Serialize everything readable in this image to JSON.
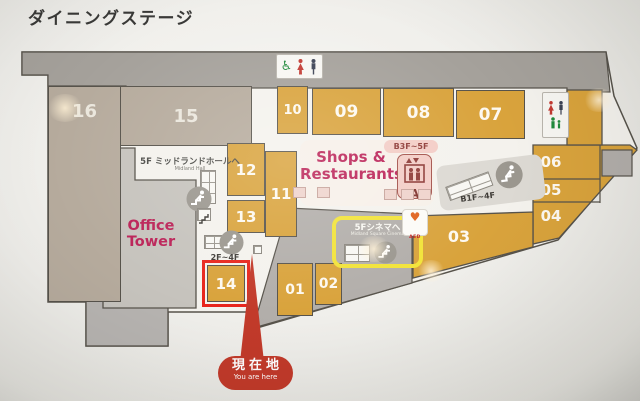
{
  "title": "ダイニングステージ",
  "sections": {
    "s16": "16",
    "s15": "15",
    "s10": "10",
    "s09": "09",
    "s08": "08",
    "s07": "07",
    "s12": "12",
    "s11": "11",
    "s13": "13",
    "s06": "06",
    "s05": "05",
    "s04": "04",
    "s03": "03",
    "s14": "14",
    "s01": "01",
    "s02": "02"
  },
  "areas": {
    "office_tower": "Office Tower",
    "shops_line1": "Shops &",
    "shops_line2": "Restaurants"
  },
  "destinations": {
    "midland_hall_jp": "5F ミッドランドホールへ",
    "midland_hall_en": "Midland Hall",
    "cinema_jp": "5Fシネマへ",
    "cinema_en": "Midland Square Cinema"
  },
  "transport": {
    "elevator_range": "B3F~5F",
    "elevator_letter": "A",
    "escalator_right_range": "B1F~4F",
    "escalator_left_range": "2F~4F"
  },
  "facilities": {
    "aed": "AED"
  },
  "you_are_here": {
    "jp": "現在地",
    "en": "You are here"
  },
  "icons": {
    "wheelchair": "♿",
    "aed_heart": "♥"
  },
  "theme": {
    "orange": "#d9a33c",
    "beige": "#b6ab9d",
    "band": "#a5a19b",
    "office": "#c6c3bd",
    "officelower": "#b7b4b1",
    "corridor": "#b2aeaa",
    "floor": "#f4f2ed",
    "outline": "#57534b",
    "magenta": "#bb2257",
    "hlred": "#e8251c",
    "hlyellow": "#f2e339",
    "pointer": "#c23a2a",
    "pink": "#f3cdc6",
    "pinkdark": "#8e3a36",
    "escgray": "#9b978f",
    "green": "#218a3c",
    "navy": "#3c4254",
    "womanred": "#c23a32",
    "aed": "#e0611c"
  }
}
